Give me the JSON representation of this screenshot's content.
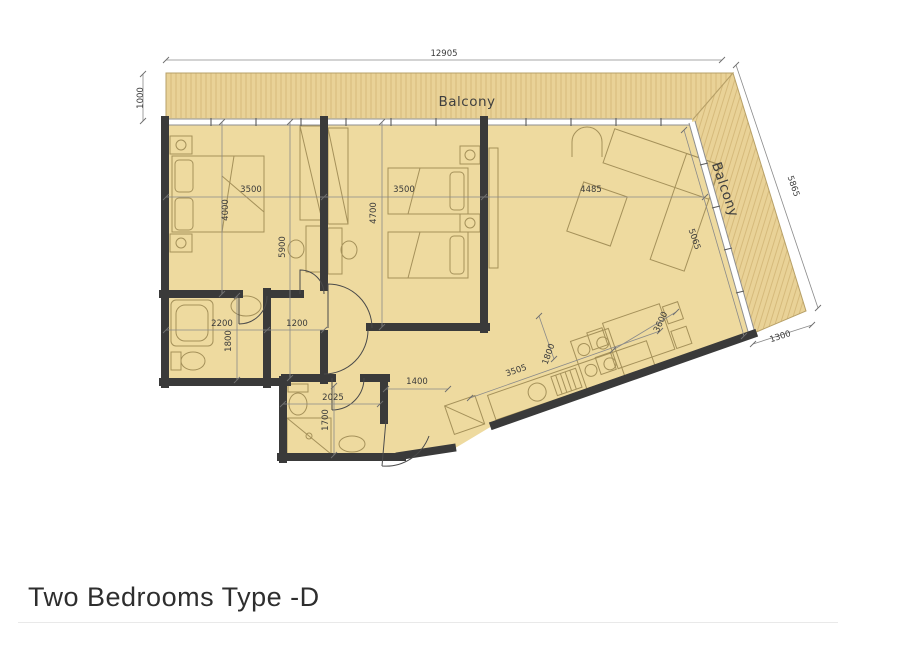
{
  "title": "Two Bedrooms Type -D",
  "labels": {
    "balcony_top": "Balcony",
    "balcony_right": "Balcony"
  },
  "dims": {
    "overall_width": "12905",
    "balcony_depth": "1000",
    "balcony_side_length": "5865",
    "balcony_side_end": "1300",
    "bed1_width": "3500",
    "bed1_depth": "4000",
    "bed2_width": "3500",
    "bed2_depth": "4700",
    "living_width": "4485",
    "living_length": "5065",
    "wing_depth": "5900",
    "bath1_width": "2200",
    "bath1_depth": "1800",
    "corridor_width": "1200",
    "bath2_width": "2025",
    "bath2_depth": "1700",
    "entry_width": "1400",
    "kitchen_run": "3505",
    "kitchen_depth": "1800",
    "dining_run": "3600"
  },
  "colors": {
    "floor": "#eeda9f",
    "balcony": "#e9d297",
    "balcony_stripe": "#d4b878",
    "wall": "#3a3a3a",
    "dimension_text": "#3b3b3b"
  }
}
